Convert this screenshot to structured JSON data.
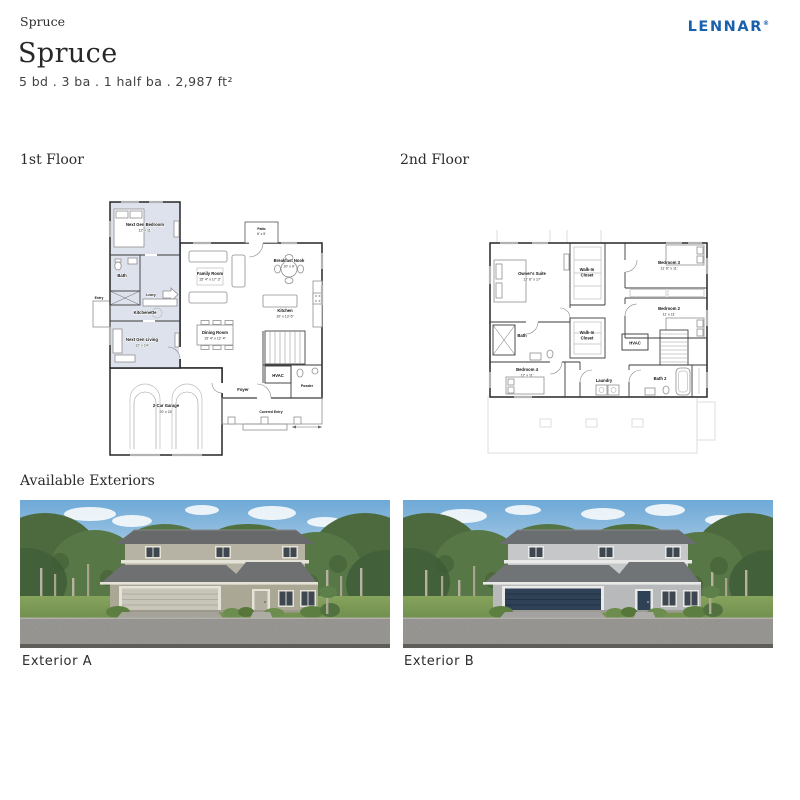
{
  "breadcrumb": {
    "label": "Spruce"
  },
  "brand": {
    "logo": "LENNAR",
    "reg": "®",
    "logo_color": "#1961ac"
  },
  "header": {
    "title": "Spruce",
    "specs": "5 bd . 3 ba . 1 half ba . 2,987 ft²"
  },
  "palette": {
    "plan_shade": "#dde2ec",
    "wall_line": "#262626"
  },
  "floors": {
    "first": {
      "label": "1st Floor",
      "rooms": {
        "next_gen_bedroom": {
          "name": "Next Gen Bedroom",
          "dims": "12' x 11'"
        },
        "bath": {
          "name": "Bath"
        },
        "lndry": {
          "name": "Lndry"
        },
        "entry": {
          "name": "Entry"
        },
        "kitchenette": {
          "name": "Kitchenette"
        },
        "next_gen_living": {
          "name": "Next Gen Living",
          "dims": "12' x 14'"
        },
        "patio": {
          "name": "Patio",
          "dims": "6' x 5'"
        },
        "family_room": {
          "name": "Family Room",
          "dims": "15' 4\" x 17' 3\""
        },
        "breakfast_nook": {
          "name": "Breakfast Nook",
          "dims": "10' x 9'"
        },
        "dining_room": {
          "name": "Dining Room",
          "dims": "15' 4\" x 12' 4\""
        },
        "kitchen": {
          "name": "Kitchen",
          "dims": "10' x 13' 6\""
        },
        "hvac": {
          "name": "HVAC"
        },
        "foyer": {
          "name": "Foyer"
        },
        "powder": {
          "name": "Powder"
        },
        "garage": {
          "name": "2-Car Garage",
          "dims": "20' x 20'"
        },
        "covered_entry": {
          "name": "Covered Entry"
        }
      }
    },
    "second": {
      "label": "2nd Floor",
      "rooms": {
        "owners_suite": {
          "name": "Owner's Suite",
          "dims": "13' 6\" x 17'"
        },
        "walk_in_closet_1": {
          "line1": "Walk-In",
          "line2": "Closet"
        },
        "bedroom3": {
          "name": "Bedroom 3",
          "dims": "11' 6\" x 11'"
        },
        "bedroom2": {
          "name": "Bedroom 2",
          "dims": "11' x 11'"
        },
        "bath": {
          "name": "Bath"
        },
        "walk_in_closet_2": {
          "line1": "Walk-In",
          "line2": "Closet"
        },
        "hvac": {
          "name": "HVAC"
        },
        "bedroom4": {
          "name": "Bedroom 4",
          "dims": "12' x 11'"
        },
        "laundry": {
          "name": "Laundry"
        },
        "bath2": {
          "name": "Bath 2"
        }
      }
    }
  },
  "exteriors": {
    "heading": "Available Exteriors",
    "a": {
      "label": "Exterior A",
      "colors": {
        "wall": "#b6b3a4",
        "wall_lower": "#aaa795",
        "roof": "#67696b",
        "roof2": "#6e7072",
        "garage_door": "#c8c5b9",
        "front_door": "#b2afa1",
        "trim": "#e5e2d8"
      }
    },
    "b": {
      "label": "Exterior B",
      "colors": {
        "wall": "#c5c7c9",
        "wall_lower": "#b7b9bb",
        "roof": "#6b6e71",
        "roof2": "#717477",
        "garage_door": "#2e4156",
        "front_door": "#2e4156",
        "trim": "#e9e9e8"
      }
    }
  }
}
